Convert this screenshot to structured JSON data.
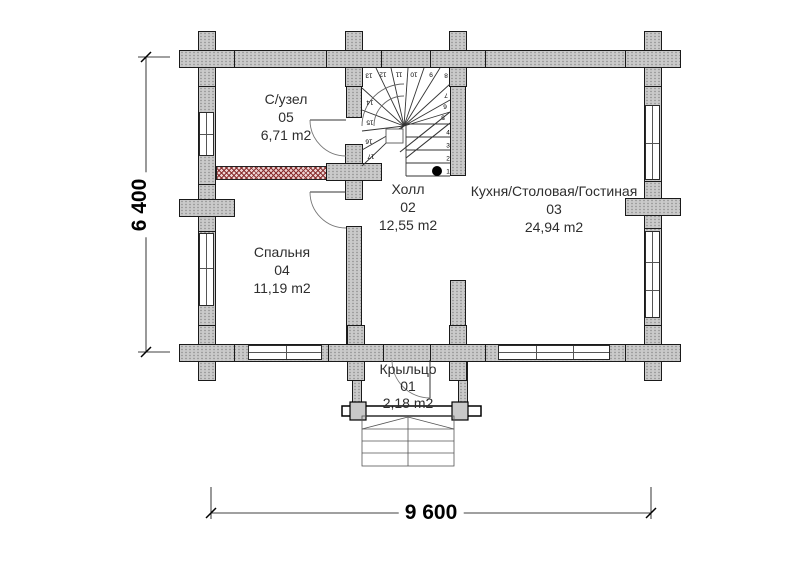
{
  "plan": {
    "rooms": {
      "bathroom": {
        "name": "С/узел",
        "number": "05",
        "area": "6,71 m2"
      },
      "hall": {
        "name": "Холл",
        "number": "02",
        "area": "12,55 m2"
      },
      "kitchen": {
        "name": "Кухня/Столовая/Гостиная",
        "number": "03",
        "area": "24,94 m2"
      },
      "bedroom": {
        "name": "Спальня",
        "number": "04",
        "area": "11,19 m2"
      },
      "porch": {
        "name": "Крыльцо",
        "number": "01",
        "area": "2,18 m2"
      }
    },
    "dimensions": {
      "horizontal": "9 600",
      "vertical": "6 400"
    },
    "stairs": {
      "steps": [
        "1",
        "2",
        "3",
        "4",
        "5",
        "6",
        "7",
        "8",
        "9",
        "10",
        "11",
        "12",
        "13",
        "14",
        "15",
        "16",
        "17"
      ]
    },
    "colors": {
      "wall_fill": "#cacaca",
      "partition_hatch": "#8a3030",
      "line": "#000000"
    }
  }
}
